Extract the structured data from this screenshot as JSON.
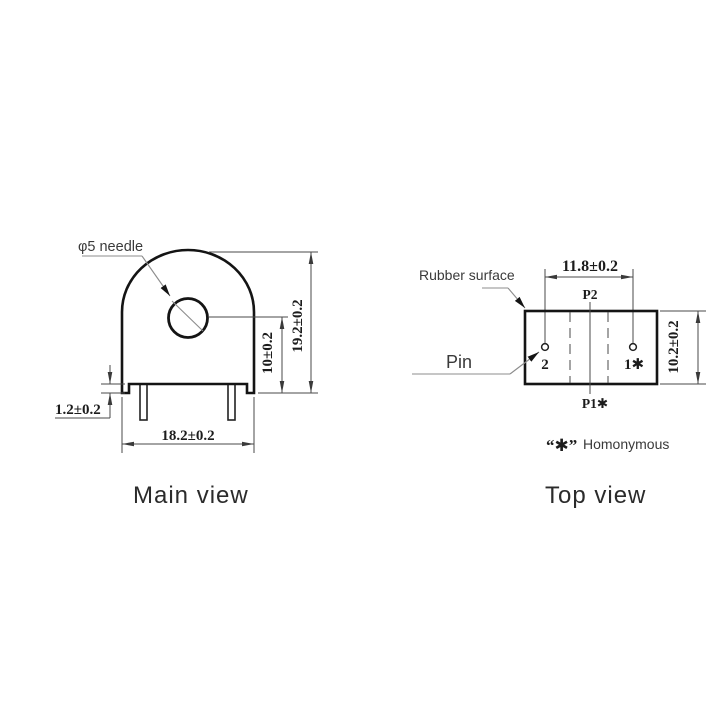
{
  "drawing": {
    "main_view": {
      "caption": "Main view",
      "hole_label": "φ5 needle",
      "dim_total_height": "19.2±0.2",
      "dim_hole_center_height": "10±0.2",
      "dim_foot_step": "1.2±0.2",
      "dim_body_width": "18.2±0.2"
    },
    "top_view": {
      "caption": "Top view",
      "rubber_label": "Rubber surface",
      "pin_label": "Pin",
      "dim_pin_spacing": "11.8±0.2",
      "dim_body_depth": "10.2±0.2",
      "terminal_top": "P2",
      "terminal_bottom": "P1✱",
      "pin_left": "2",
      "pin_right": "1✱"
    },
    "legend": {
      "symbol": "“✱”",
      "label": "Homonymous"
    },
    "colors": {
      "outline": "#141414",
      "dimension_lines": "#4a4a4a",
      "leader_lines": "#8c8c8c",
      "background": "#ffffff"
    }
  }
}
